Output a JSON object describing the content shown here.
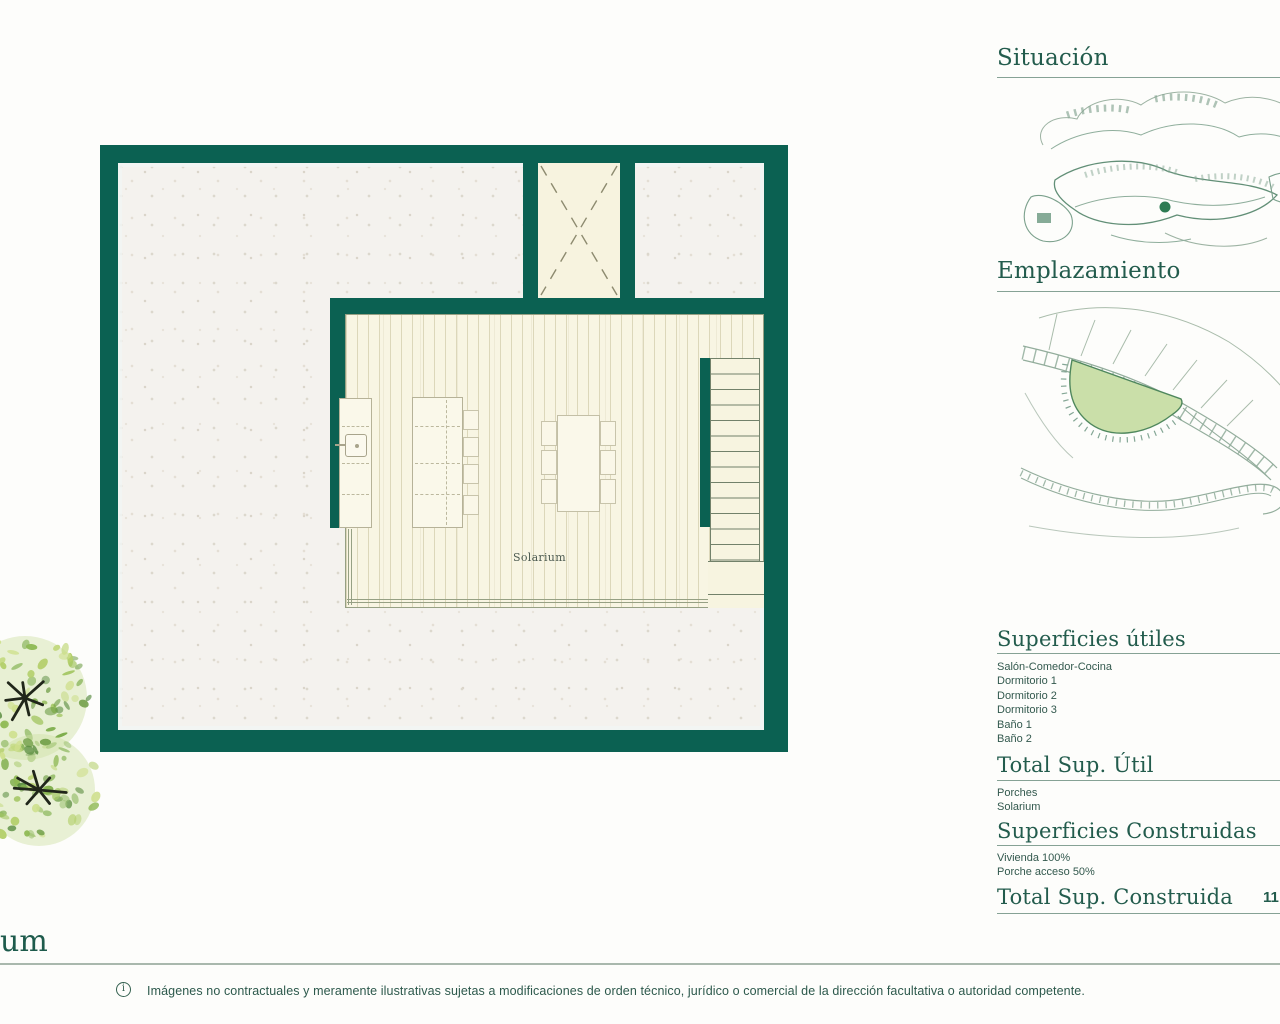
{
  "floor_plan": {
    "room_label": "Solarium"
  },
  "sidebar": {
    "situacion_title": "Situación",
    "emplazamiento_title": "Emplazamiento",
    "superficies_utiles": {
      "title": "Superficies útiles",
      "items": [
        "Salón-Comedor-Cocina",
        "Dormitorio 1",
        "Dormitorio 2",
        "Dormitorio 3",
        "Baño 1",
        "Baño 2"
      ]
    },
    "total_sup_util": {
      "title": "Total Sup. Útil",
      "items": [
        "Porches",
        "Solarium"
      ]
    },
    "superficies_construidas": {
      "title": "Superficies Construidas",
      "items": [
        "Vivienda 100%",
        "Porche acceso 50%"
      ]
    },
    "total_sup_construida": {
      "title": "Total Sup. Construida",
      "value_clipped": "11"
    }
  },
  "footer": {
    "page_title_fragment": "um",
    "info_icon_glyph": "i",
    "disclaimer": "Imágenes no contractuales y meramente ilustrativas sujetas a modificaciones de orden técnico, jurídico o comercial de la dirección facultativa o autoridad competente."
  },
  "colors": {
    "wall_green": "#0b6152",
    "heading_green": "#235c4d",
    "body_text_green": "#33594e",
    "deck_cream": "#f8f5e3",
    "terrace_speckle_base": "#f4f2ee",
    "highlight_plot_fill": "#cadfa9",
    "map_line_light": "#8fae9c",
    "map_line_dark": "#54836c"
  }
}
